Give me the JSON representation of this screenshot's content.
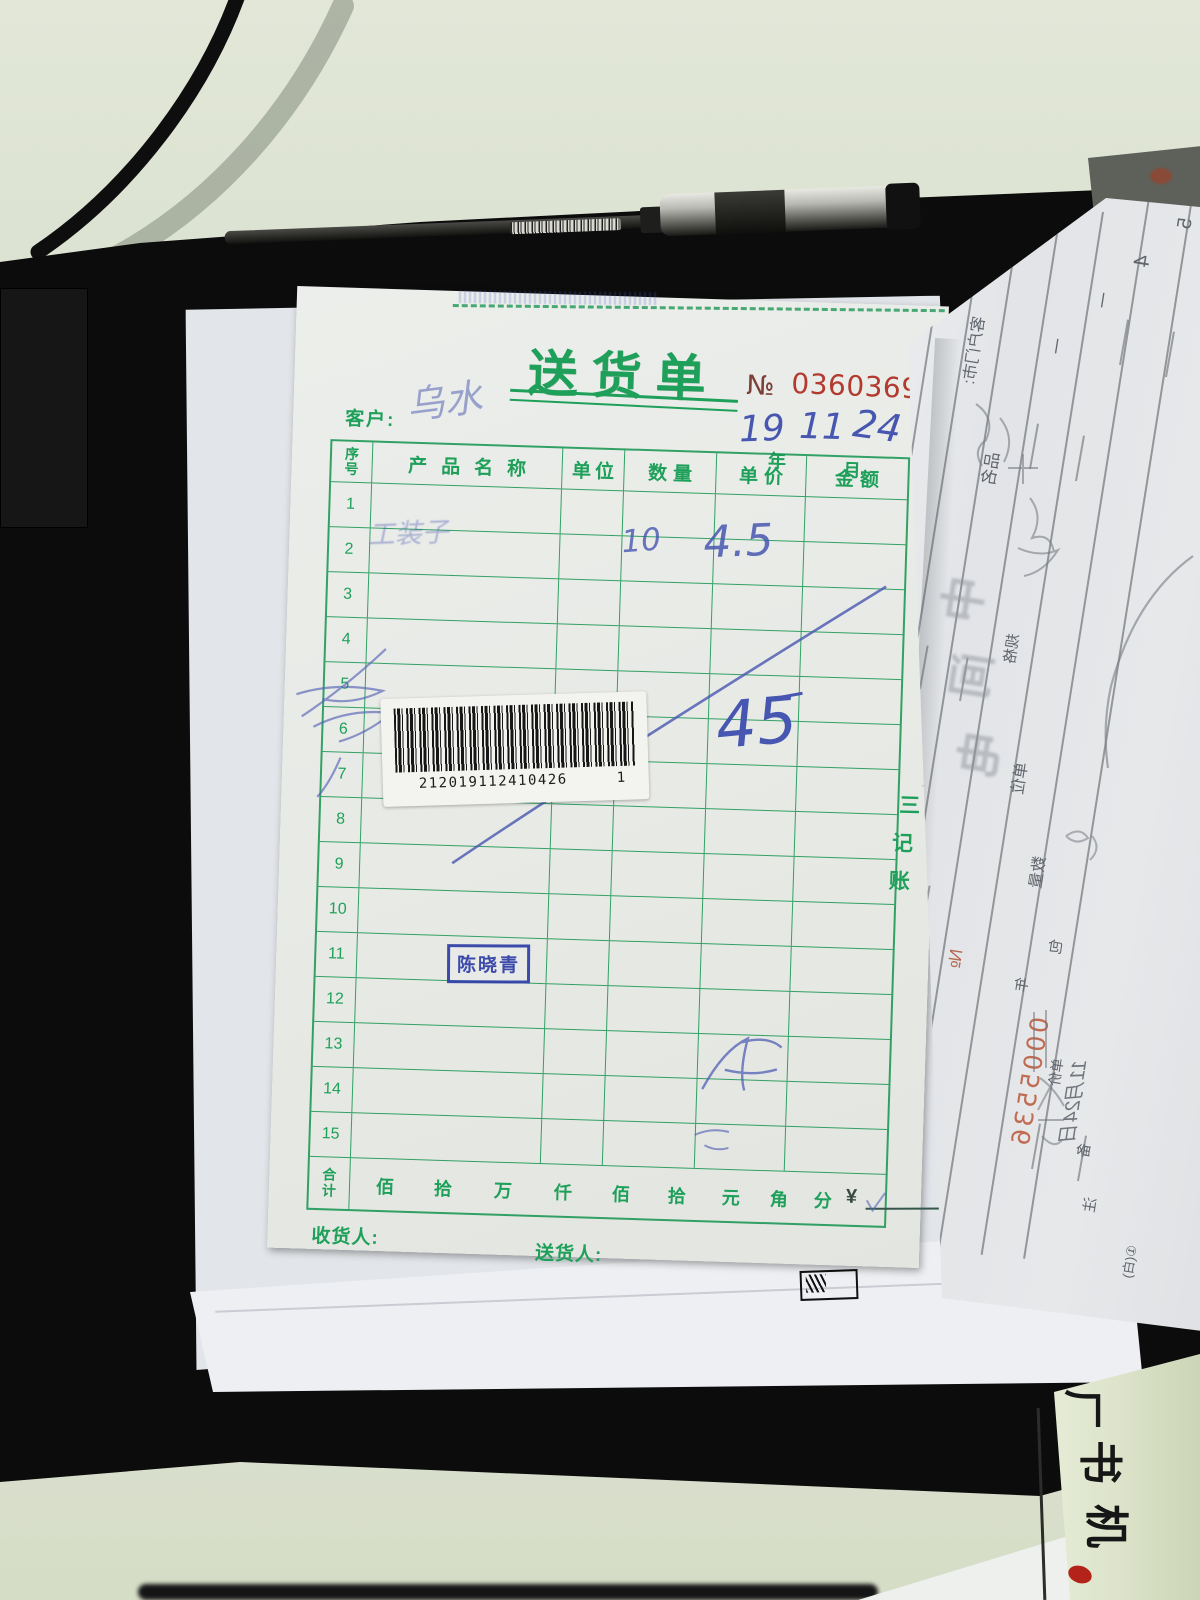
{
  "delivery_note": {
    "title": "送货单",
    "no_label": "№",
    "number": "0360369",
    "customer_label": "客户:",
    "customer_hw": "乌水",
    "year_label": "年",
    "month_label": "月",
    "day_label": "日",
    "year_hw": "19",
    "month_hw": "11",
    "day_hw": "24",
    "table": {
      "header": {
        "c1a": "序",
        "c1b": "号",
        "c2": "产品名称",
        "c3": "单位",
        "c4": "数量",
        "c5": "单价",
        "c6": "金额"
      },
      "rows": [
        {
          "no": "1"
        },
        {
          "no": "2"
        },
        {
          "no": "3"
        },
        {
          "no": "4"
        },
        {
          "no": "5"
        },
        {
          "no": "6"
        },
        {
          "no": "7"
        },
        {
          "no": "8"
        },
        {
          "no": "9"
        },
        {
          "no": "10"
        },
        {
          "no": "11"
        },
        {
          "no": "12"
        },
        {
          "no": "13"
        },
        {
          "no": "14"
        },
        {
          "no": "15"
        }
      ],
      "total_a": "合",
      "total_b": "计",
      "units": [
        "佰",
        "拾",
        "万",
        "仟",
        "佰",
        "拾",
        "元",
        "角",
        "分"
      ],
      "yen": "¥"
    },
    "row2_hw": {
      "product": "工装子",
      "qty": "10",
      "price": "4.5"
    },
    "amount_hw": "45",
    "barcode": {
      "digits": "212019112410426",
      "suffix": "1"
    },
    "stamp": "陈晓青",
    "copy_marks": [
      "三",
      "记",
      "账"
    ],
    "receiver_label": "收货人:",
    "deliverer_label": "送货人:"
  },
  "right_page": {
    "kehu": "客户门市:",
    "pinming": "品名",
    "guige": "规格",
    "danwei": "单位",
    "shuliang": "数量",
    "danjia": "单价",
    "bao": "包",
    "bei": "备",
    "zhu": "注",
    "nian": "年",
    "no_label": "№",
    "number": "0005536",
    "date_hw": "11月24日",
    "footer_mark": "①(白)",
    "corner_a": "4",
    "corner_b": "5",
    "dash": "一",
    "ghost": [
      "中",
      "间",
      "电"
    ]
  },
  "desk": {
    "strip_partial": "厂",
    "strip_char_1": "书",
    "strip_char_2": "机"
  },
  "colors": {
    "form_green": "#1fa05a",
    "serial_red": "#b23a2e",
    "ink_blue": "#4756b0",
    "stamp_blue": "#2e3da6",
    "right_page_red": "#c06b52"
  }
}
